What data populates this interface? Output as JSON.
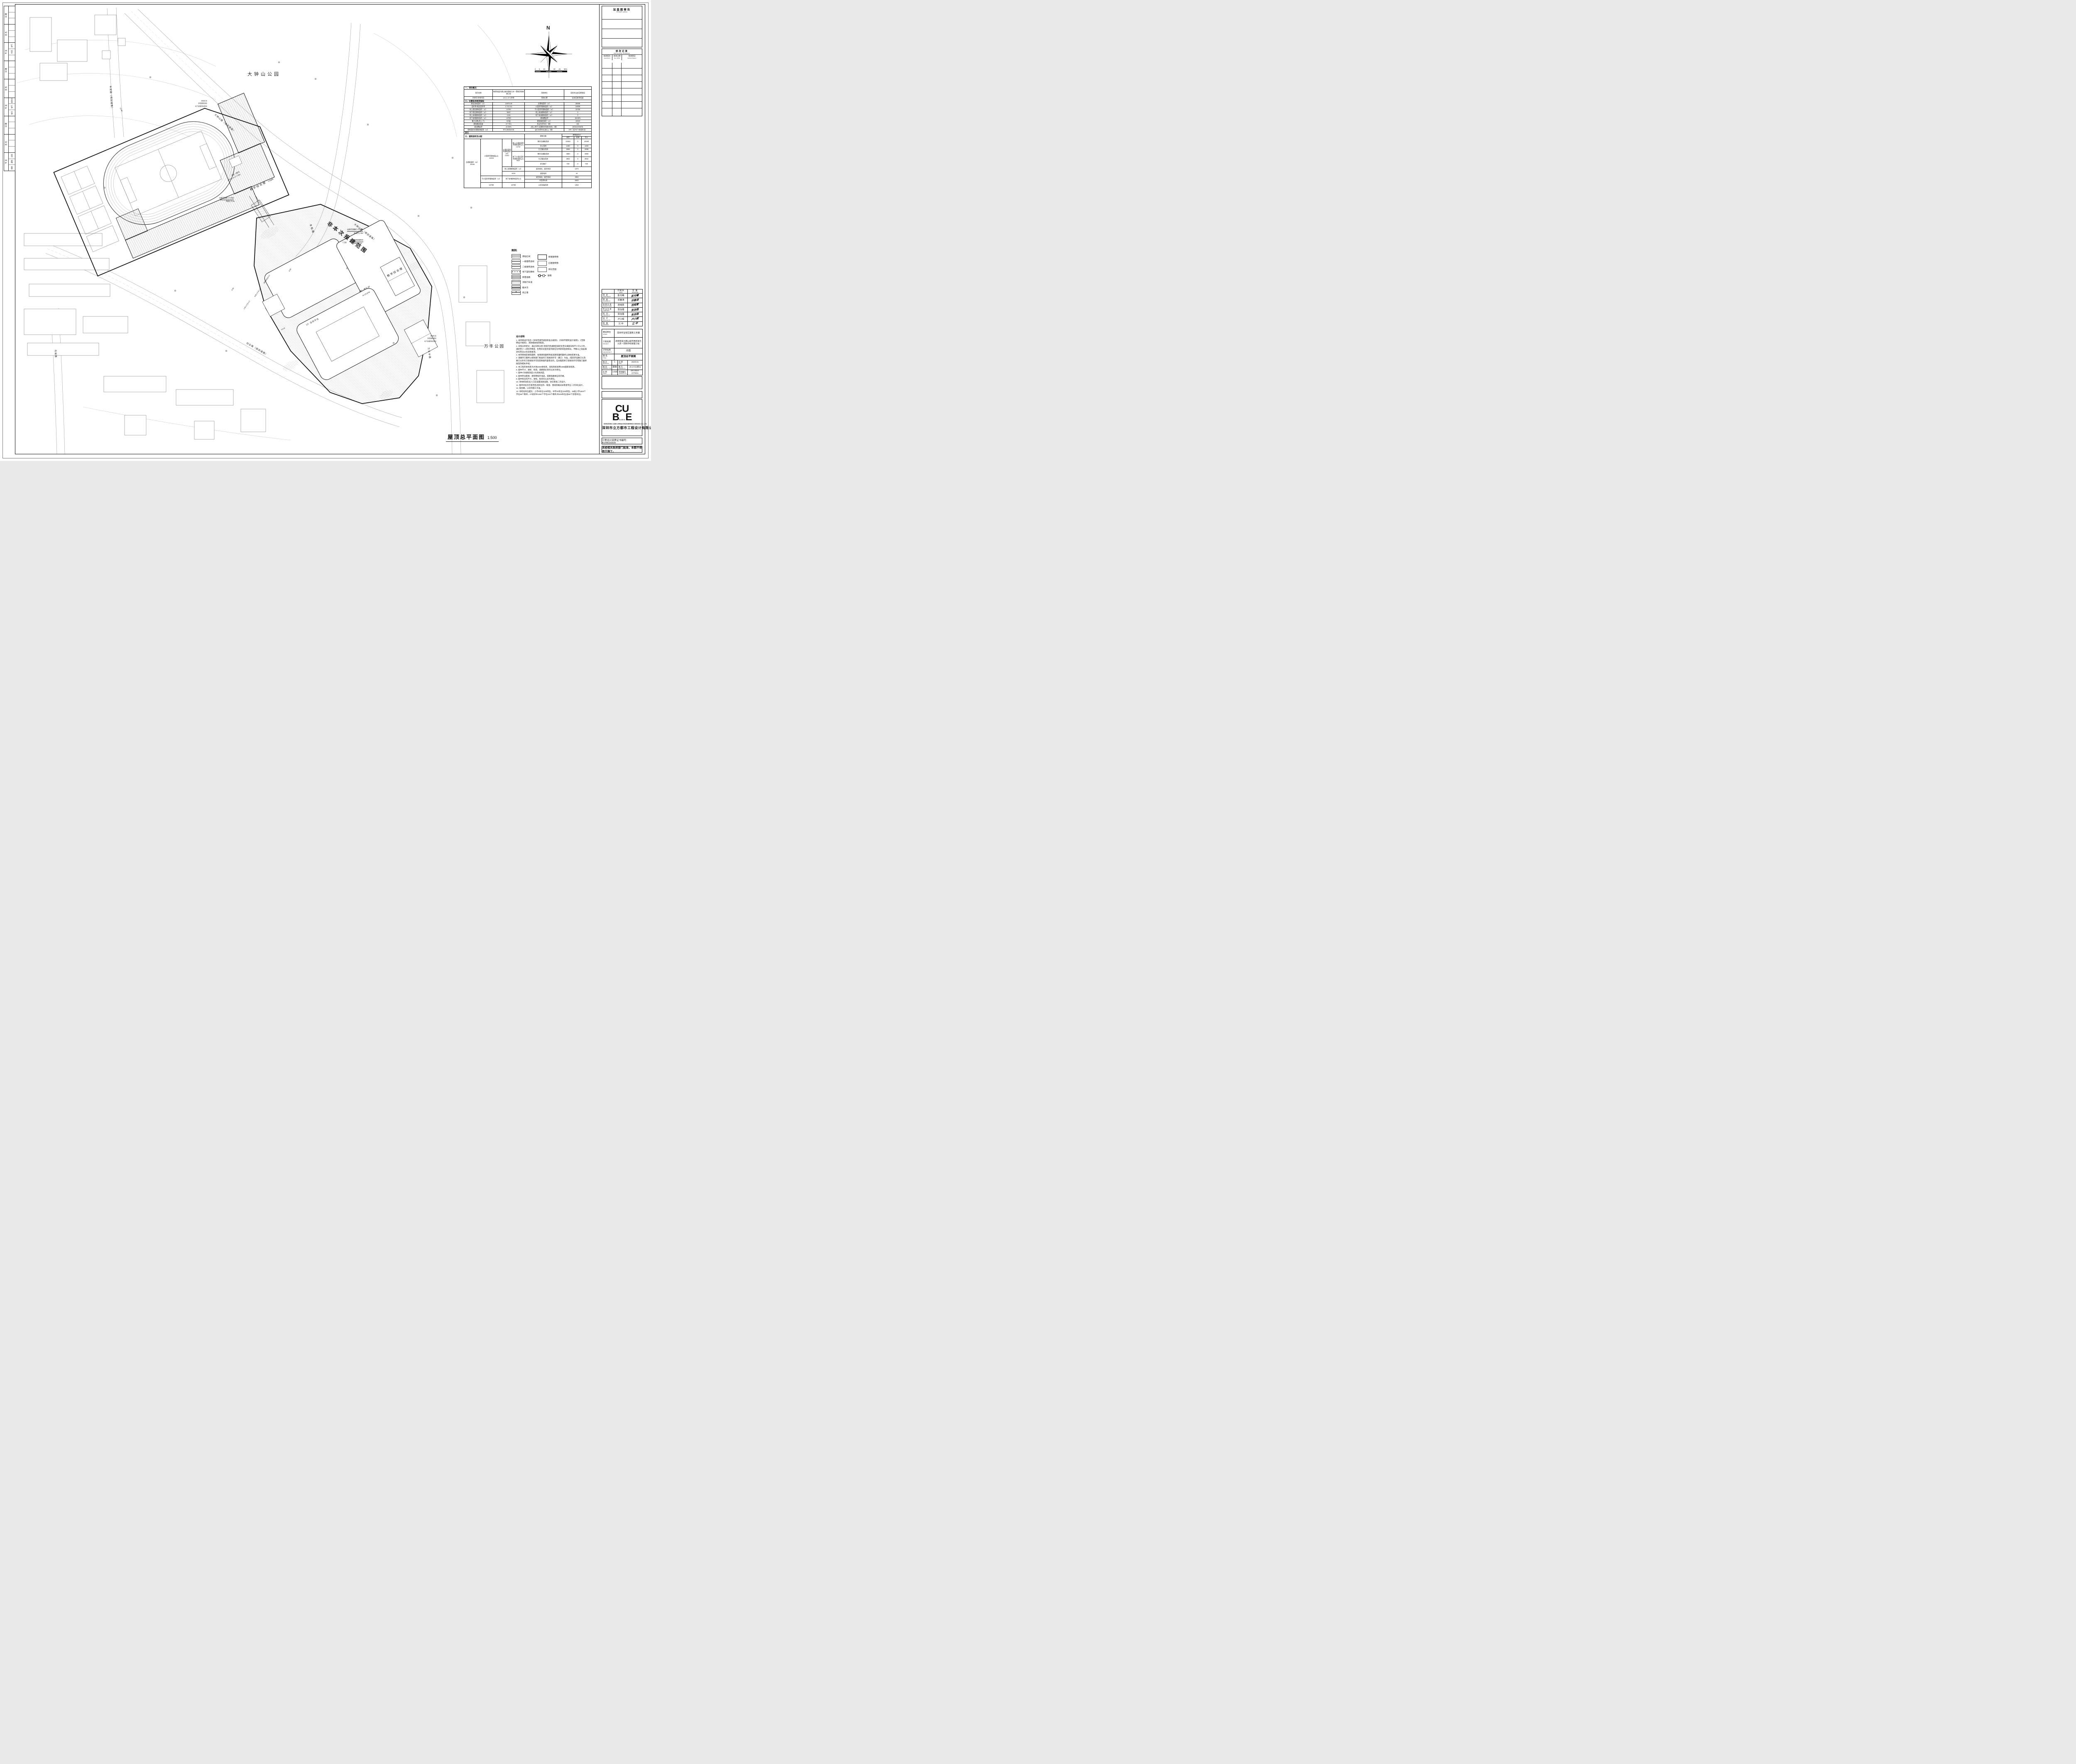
{
  "compass": {
    "n": "N"
  },
  "scalebar": {
    "labels": [
      "0",
      "5",
      "10",
      "15",
      "20",
      "25",
      "30m"
    ]
  },
  "main_title": {
    "zh": "屋顶总平面图",
    "scale": "1:500"
  },
  "stamp": {
    "title": "加盖图章处",
    "subtitle": "STAMP AREA"
  },
  "revision": {
    "title": "修改记录",
    "subtitle": "REIVISON REMARK",
    "cols": [
      {
        "zh": "修改版次",
        "en": "Amendment"
      },
      {
        "zh": "修改日期",
        "en": "Rev. DATE"
      },
      {
        "zh": "修改原因",
        "en": "Reivison Reason"
      }
    ]
  },
  "signoff": {
    "print_zh": "印刷体",
    "print_en": "PRINT",
    "sign_zh": "签 署",
    "sign_en": "SIGNATURE",
    "rows": [
      {
        "zh": "审 定",
        "en": "APPROVED BY",
        "name": "彭光曦"
      },
      {
        "zh": "审 核",
        "en": "EXAMINED BY",
        "name": "邓春涛"
      },
      {
        "zh": "项目负责",
        "en": "PROJECT CHIEF",
        "name": "范纯青"
      },
      {
        "zh": "专业负责",
        "en": "CHIEF ENGI.",
        "name": "张治强"
      },
      {
        "zh": "校 对",
        "en": "CHECKED BY",
        "name": "张治强"
      },
      {
        "zh": "设 计",
        "en": "DESIGNED BY",
        "name": "卢小辉"
      },
      {
        "zh": "制 图",
        "en": "DRAWN BY",
        "name": "江 中"
      }
    ]
  },
  "project": {
    "client_zh": "建设单位",
    "client_en": "CLIENT",
    "client_v": "深圳市宝安区建筑工务署",
    "proj_zh": "工程名称",
    "proj_en": "PROJECT",
    "proj_v1": "新桥街道大朗山城市更新单元",
    "proj_v2": "九年一贯制学校新建工程",
    "sub_zh": "子项名称",
    "sub_en": "SUB-PROJECT",
    "sub_v": "总图",
    "title_zh": "图 名",
    "title_en": "TITLE",
    "title_v": "屋顶总平面图"
  },
  "edition": {
    "rows": [
      {
        "l1": "版 次",
        "e1": "EDITION No.",
        "v1": "1",
        "l2": "日 期",
        "e2": "DATE",
        "v2": "2026.01"
      },
      {
        "l1": "图 别",
        "e1": "DRAWING TYPE",
        "v1": "建施",
        "l2": "图 号",
        "e2": "DRAWING No.",
        "v2": "JS-Z-01(修1)"
      },
      {
        "l1": "比 例",
        "e1": "SCALE",
        "v1": "1:500",
        "l2": "项目编号",
        "e2": "CONTRACT No.",
        "v2": "DS.2024-077E01"
      }
    ]
  },
  "company": {
    "logo_top": "CU",
    "logo_bottom": "BE",
    "logo_small": "SUEO",
    "en": "SHENZHEN CUBE-URBAN ENGINEERING DESIGN CO.,LTD.",
    "zh": "深圳市立方都市工程设计有限公司"
  },
  "cert": "工程设计资质证书编号：A144016509",
  "notice": "未经相关政府部门批准，本图不得用于施工。",
  "sidebar": {
    "sections": [
      {
        "label": "日 期",
        "i1": "",
        "i2": "",
        "i3": ""
      },
      {
        "label": "签 名",
        "i1": "",
        "i2": "",
        "i3": ""
      },
      {
        "label": "专 业",
        "i1": "燃气",
        "i2": "空调",
        "i3": ""
      },
      {
        "label": "日 期",
        "i1": "",
        "i2": "",
        "i3": ""
      },
      {
        "label": "签 名",
        "i1": "",
        "i2": "",
        "i3": ""
      },
      {
        "label": "专 业",
        "i1": "给排水",
        "i2": "电气",
        "i3": "电讯"
      },
      {
        "label": "日 期",
        "i1": "",
        "i2": "",
        "i3": ""
      },
      {
        "label": "签 名",
        "i1": "",
        "i2": "",
        "i3": ""
      },
      {
        "label": "专 业",
        "i1": "总图",
        "i2": "建筑",
        "i3": "结构"
      }
    ]
  },
  "overview": {
    "sec1": "一、项目概况",
    "r1": {
      "l1": "项目名称",
      "v1": "新桥街道大朗山城市更新九年一贯制学校新建工程",
      "l2": "用地单位",
      "v2": "深圳市宝安区教育局"
    },
    "r2": {
      "l1": "宗地号/宗地代码",
      "v1": "A313-1574宗地",
      "l2": "用地位置",
      "v2": "宝安区新桥街道"
    },
    "sec2": "二、主要技术经济指标",
    "indicators": [
      {
        "l1": "建设用地面积（㎡）",
        "v1": "14575.48",
        "l2": "总建筑面积（㎡）",
        "v2": "35588"
      },
      {
        "l1": "容积率/规定容积率",
        "v1": "1.71/1.61",
        "l2": "计容积率建筑面积（㎡）",
        "v2": "24808"
      },
      {
        "l1": "地上规定建筑面积（㎡）",
        "v1": "13750",
        "l2": "不计容积率建筑面积（㎡）",
        "v2": "10780"
      },
      {
        "l1": "地下规定建筑面积（㎡）",
        "v1": "9642",
        "l2": "地上核减建筑面积（㎡）",
        "v2": "0"
      },
      {
        "l1": "地上核增建筑面积（㎡）",
        "v1": "1416",
        "l2": "地下核减建筑面积（㎡）",
        "v2": "0"
      },
      {
        "l1": "地下核增建筑面积（㎡）",
        "v1": "10780",
        "l2": "建筑覆盖率",
        "v2": "68.68%"
      },
      {
        "l1": "最大层数(地上/下)",
        "v1": "6/2层",
        "l2": "建筑基底面积（㎡）",
        "v2": "10010"
      },
      {
        "l1": "建筑最高高度",
        "v1": "27.70m",
        "l2": "机动车停车位（辆）",
        "v2": "151"
      },
      {
        "l1": "绿化覆盖率",
        "v1": "10.93%",
        "l2": "(地上/地下/无障碍/充电桩/校车)（辆）",
        "v2": "(0/151/2/46/0)"
      },
      {
        "l1": "绿地面积/折算绿地面积（㎡）",
        "v1": "974.29/618.66",
        "l2": "自行车停车位(地上)（辆）",
        "v2": "370（含76个充电车位）"
      }
    ],
    "other": "其它"
  },
  "alloc": {
    "sec": "三、建筑面积及分配",
    "fn_header": "建筑功能",
    "area_header": "建筑面积㎡",
    "sub_headers": [
      "规定",
      "核减",
      "合计"
    ],
    "total_label": "总建筑面积（㎡）",
    "total_value": "35588",
    "jr_label": "计容积率建筑面(㎡)",
    "jr_value": "24808",
    "jrg_label": "计规定容积率建筑面积(㎡)",
    "jrg_value": "23392",
    "up_label": "地上计规定容积率建筑面积(㎡)",
    "up_value": "13750",
    "down_label": "地下计规定容积率建筑面积(㎡)",
    "down_value": "9642",
    "up_rows": [
      {
        "fn": "教学及辅助用房",
        "a": "10192",
        "b": "0",
        "c": "10192"
      },
      {
        "fn": "办公用房",
        "a": "1460",
        "b": "0",
        "c": "1460"
      },
      {
        "fn": "生活服务用房",
        "a": "2098",
        "b": "0",
        "c": "2098"
      }
    ],
    "down_rows": [
      {
        "fn": "教学及辅助用房",
        "a": "4990",
        "b": "0",
        "c": "4990"
      },
      {
        "fn": "生活服务用房",
        "a": "3932",
        "b": "0",
        "c": "3932"
      },
      {
        "fn": "多功能厅",
        "a": "720",
        "b": "0",
        "c": "720"
      }
    ],
    "shang_hz_label": "地上核增建筑面积（㎡）",
    "shang_hz_value": "1416",
    "shang_hz_rows": [
      {
        "fn": "架空绿化、架空休闲",
        "v": "1372"
      },
      {
        "fn": "变配电房",
        "v": "44"
      }
    ],
    "bjr_label": "不计容积率建筑面积（㎡）",
    "bjr_value": "10780",
    "xia_hz_label": "地下核增建筑面积(㎡)",
    "xia_hz_value": "10780",
    "xia_hz_rows": [
      {
        "fn": "架空绿化、架空休闲",
        "v": "2592"
      },
      {
        "fn": "共用停车库",
        "v": "6825"
      }
    ],
    "last_fn": "公用设备用房",
    "last_v": "1363"
  },
  "legend": {
    "title": "图例:",
    "left": [
      {
        "sym": "redline",
        "label": "用地红线"
      },
      {
        "sym": "setback1",
        "label": "一级建筑退线"
      },
      {
        "sym": "setback2",
        "label": "二级建筑退线"
      },
      {
        "sym": "basement",
        "label": "地下室轮廓线"
      },
      {
        "sym": "newroad",
        "label": "新建道路"
      },
      {
        "sym": "fire",
        "label": "消防行车道"
      },
      {
        "sym": "ditch",
        "label": "截水沟"
      },
      {
        "sym": "retain",
        "label": "挡土墙"
      }
    ],
    "right": [
      {
        "sym": "newbld",
        "label": "新建建筑物"
      },
      {
        "sym": "oldbld",
        "label": "已建建筑物"
      },
      {
        "sym": "green",
        "label": "绿化范围"
      },
      {
        "sym": "wall",
        "label": "围墙"
      }
    ]
  },
  "notes": {
    "title": "设计说明:",
    "items": [
      "1. 本项目设计符合《深圳市城市规划标准与规则》、《深圳市建筑设计规则》、《无障碍设计规则》、消防相关规范规定。",
      "2. 日照分析结论：通过日照分析,地块内普通教室满足冬至日满窗日照不小于2小时，满足至少一间科学教室、生物实验室的室内能在冬季获得直射阳光，半数以上宿舍满足冬至日1h的日照要求。",
      "3. 本项目规定建筑面积、核增建筑面积和核减建筑面积最终以测绘结果为准。",
      "4. 道路开口最终以规划部门批复的工程规划许可（路口）为准。(但因开设路口以及路口以外的工程规划许可及其附图内容变化的，应办理变更工程规划许可或施工图修备案改相关手续)",
      "5. 本工程的坐标系为大地2000坐标系，高程系统采用1985国家高程系。",
      "6. 图中尺寸、坐标、标高、道路坡长等均以米为单位。",
      "7. 图中H为规划高度,h为消防高度。",
      "8. 图中所注距离：建筑物指外墙皮，道路指路缘石的内缘。",
      "9. 图中标注的尺寸，坐标，标高均以米为单位。",
      "10. 场地机动车出入口应设置减速设施，详见景观二次设计。",
      "11. 图中绿化仅示意范围,连同台阶、坡道、围墙等做法详景观专业二次深化设计。",
      "12. 规划路，以实际施工为准。",
      "13. 非机动车位配比：小学8车位/100师生，中学20车位/100师生，36班小学1620个学位86个教师，27班初中1350个学位102个教师,共428车位(含86个充电车位)。"
    ]
  },
  "plan": {
    "park_top": "大钟山公园",
    "park_right": "万丰公园",
    "out_of_scope": "非本次报建范围",
    "roads": {
      "dzs1": "大钟山路（规划道路）",
      "dzs2": "大钟山路（规划道路）",
      "fh": "丰和路",
      "wf": "万丰中路",
      "cy": "创业路（规划道路）",
      "fa": "丰安路（规划道路）",
      "sy": "石岩路"
    },
    "bld2_line1": "2栋一单元",
    "bld2_line2": "6F/2D H=27.70M",
    "bld2_name": "教学综合楼",
    "bld6_line1": "6栋一单元 6F",
    "bld6_line2": "H=23.97M",
    "bld6_name": "教学综合楼",
    "platform": "2F 活动平台",
    "sunken": "下沉庭院",
    "guard": "门卫室",
    "note_corridor1": "连廊范围属于小学部",
    "note_corridor2": "净高大于6M",
    "note_fire1": "消防车道穿越建筑处",
    "note_fire2": "净高大于4M",
    "boundary_notes": [
      "用地红线",
      "多层建筑退线",
      "地下室建筑轮廓线"
    ],
    "entrances": [
      "中学人行主入口",
      "消防紧急出入口",
      "小学人行主入口"
    ],
    "dims": [
      "8.00",
      "6.00",
      "13.90",
      "43.18"
    ]
  }
}
